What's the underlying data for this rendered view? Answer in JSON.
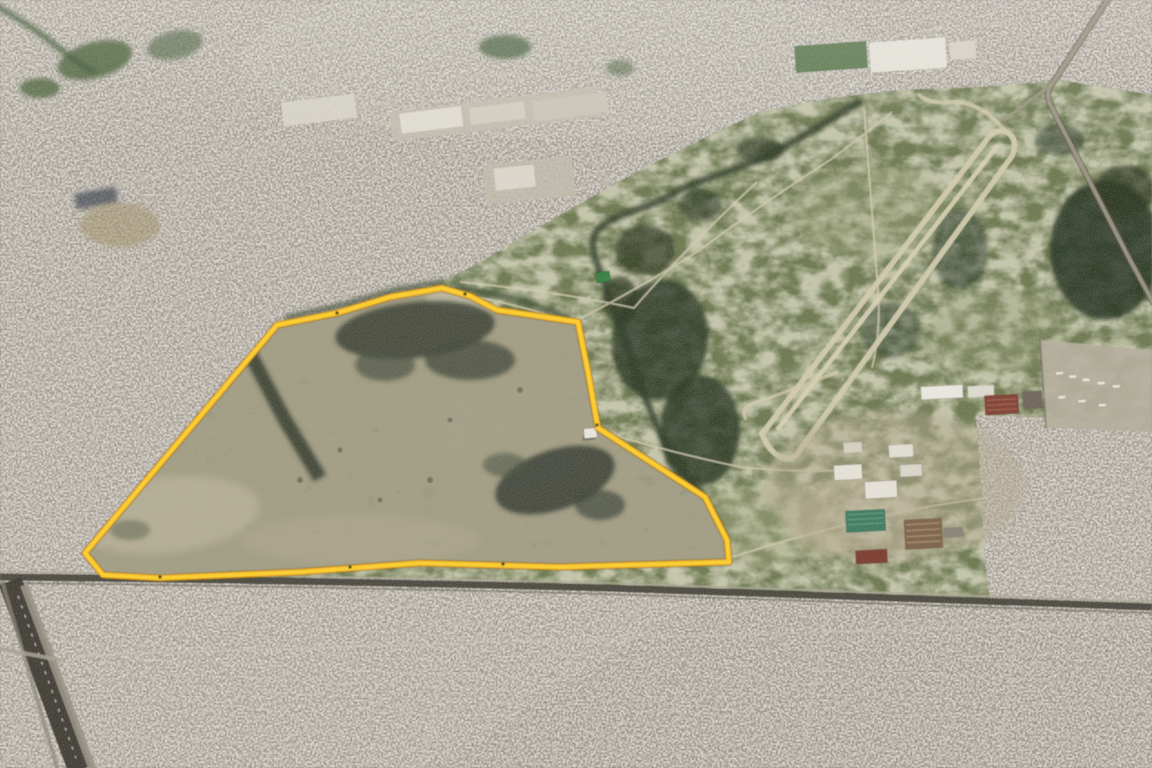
{
  "image": {
    "kind": "oblique aerial satellite photograph",
    "description": "Bird's-eye 3D satellite view of a dense low-rise city surrounding a large undeveloped green area. A vacant grassland parcel with dark burn scars is outlined with a thick yellow boundary. To its right lies an abandoned racetrack/airfield loop, a tree-lined stream, industrial sheds and greenhouses. A railway/avenue corridor runs along the bottom of the parcel and a sunken highway crosses the lower-left corner.",
    "annotation_label": "yellow parcel boundary",
    "visible_text": "none"
  },
  "palette": {
    "urban_base": "#958d80",
    "urban_light_speckle": "#efece4",
    "urban_dark_speckle": "#38362f",
    "street_line": "#d8d1c3",
    "grass": "#6d7950",
    "grass_dry": "#b7b28e",
    "tree_dark": "#26331f",
    "parcel_fill": "#a29d83",
    "burn_scar": "#3a4034",
    "track_pale": "#d4ccae",
    "path_pale": "#d5cdb2",
    "rail_dark": "#45423a",
    "highway_dark": "#3a372f",
    "boundary_yellow": "#ffd02a",
    "boundary_amber": "#f5a80b",
    "boundary_shadow": "#7a5e08"
  },
  "parcel": {
    "name": "highlighted vacant parcel",
    "outline_points": "85,553 277,325 337,313 390,297 442,288 470,296 497,310 578,322 588,372 598,428 705,497 727,540 729,562 560,567 420,563 300,572 160,578 103,575",
    "stroke_width": 3.8
  },
  "open_land": {
    "name": "undeveloped green area",
    "points": "85,553 103,576 300,578 420,578 600,585 760,592 990,601 985,560 980,470 976,415 1060,418 1152,428 1152,95 1060,80 1000,86 900,90 830,98 760,112 700,140 640,170 560,215 480,262 450,278 423,290 390,297 337,313 277,325"
  },
  "racetrack": {
    "name": "abandoned racetrack / airfield loop",
    "loop_path": "M762,434 L985,142 Q994,128 1006,132 Q1019,138 1012,156 L800,450 Q793,463 780,457 Q768,450 762,434 Z",
    "runway_path": "M777,430 L998,145",
    "esses_path": "M1006,132 Q980,100 950,102 Q928,104 918,94",
    "hook_path": "M838,372 Q770,398 752,404 Q740,408 746,420"
  },
  "stream": {
    "name": "tree-lined stream",
    "path": "M862,100 C830,120 790,145 762,158 C725,175 700,178 668,196 C640,212 610,214 596,232 C588,244 596,262 606,286 C618,318 632,360 648,404 C662,442 680,470 700,492 L716,522 L726,550",
    "hedge_path": "M285,318 L340,306 L395,290 L445,282 M455,286 L520,300 L570,318"
  },
  "field_paths": {
    "name": "dirt tracks across grassland",
    "path": "M295,320 Q380,299 445,291 Q520,304 572,323 M572,323 Q640,288 700,250 Q760,205 830,160 Q868,132 892,112 M460,282 Q560,292 634,308 Q682,252 757,182 M598,430 Q660,450 740,467 Q800,473 852,470 M729,558 Q810,532 900,512 Q952,502 988,498 M864,108 Q871,200 878,290 Q881,332 872,368"
  },
  "railway_ne": {
    "name": "railway junction north-east",
    "main_path": "M1110,-4 L1052,84 Q1044,94 1052,108 L1130,260 L1154,304",
    "branch_path": "M1052,84 L1004,120"
  },
  "boundary_road": {
    "name": "railway and avenue along parcel south edge",
    "dark_path": "M0,577 Q300,580 606,588 Q880,597 1152,607",
    "pale_path": "M0,572 Q300,575 606,583 Q880,592 1152,602",
    "rail_path": "M0,583 Q300,586 606,594 Q880,603 1152,613"
  },
  "highway_sw": {
    "name": "sunken highway south-west corner",
    "dark_path": "M10,581 L80,770",
    "pavement_path": "M24,585 L93,770",
    "edge_path": "M2,581 L58,770",
    "dashes_path": "M18,596 L76,758",
    "overpass_path": "M-4,648 L60,660"
  },
  "city": {
    "name": "dense urban fabric",
    "avenues_path": "M0,212 L505,97 M70,380 L300,2 M80,655 L1152,622 M420,768 L458,612 M800,768 L828,606 M1000,762 L1018,610 M700,60 L1000,22"
  },
  "buildings": {
    "small_white_building_in_parcel": {
      "x": 584,
      "y": 428,
      "w": 13,
      "h": 10
    },
    "green_shed": {
      "x": 596,
      "y": 272,
      "w": 14,
      "h": 10
    },
    "industrial_cluster_east": "white warehouses, teal greenhouses, red-roofed sheds",
    "industrial_blob_north": "large pale warehouse complex",
    "truck_lot_east_edge": "pale logistics yard with parked trailers"
  }
}
